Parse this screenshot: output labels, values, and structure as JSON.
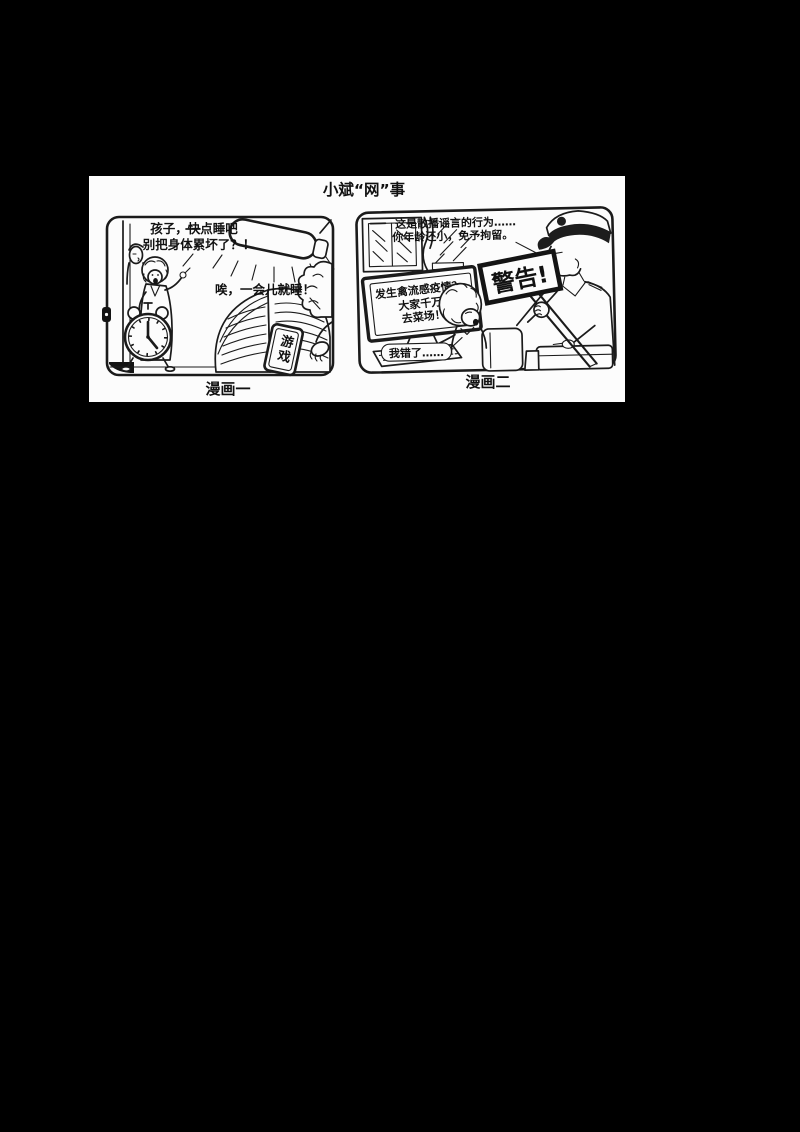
{
  "colors": {
    "background": "#000000",
    "paper": "#fcfcfc",
    "ink": "#1b1b1b"
  },
  "title": "小斌“网”事",
  "comic1": {
    "caption": "漫画一",
    "mother_speech": [
      "孩子，快点睡吧",
      "别把身体累坏了？！"
    ],
    "boy_reply": "唉，一会儿就睡！",
    "tablet_label": "游戏"
  },
  "comic2": {
    "caption": "漫画二",
    "officer_speech": [
      "这是散播谣言的行为……",
      "你年龄还小，免予拘留。"
    ],
    "screen_post": [
      "发生禽流感疫情？",
      "大家千万不要",
      "去菜场！"
    ],
    "sign_text": "警告!",
    "boy_apology": "我错了……"
  }
}
